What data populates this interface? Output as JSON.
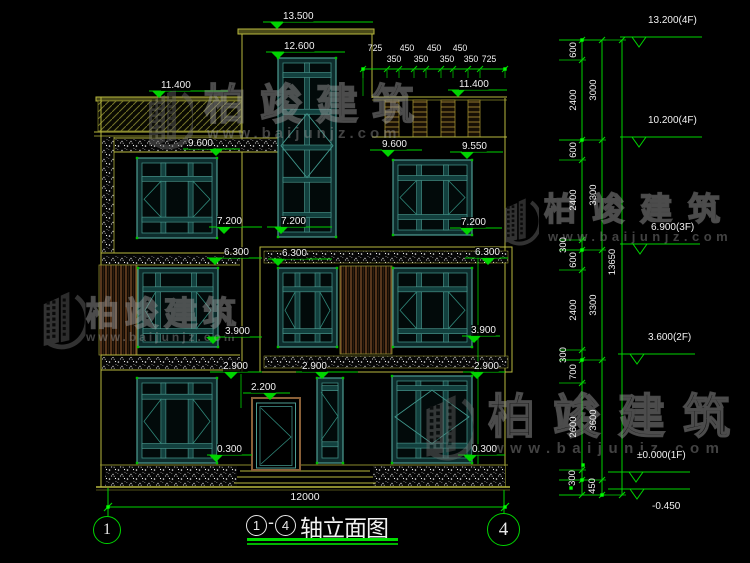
{
  "drawing": {
    "title": {
      "axis_start": "1",
      "dash": "-",
      "axis_end": "4",
      "name": "轴立面图"
    },
    "overall_dim": {
      "value": "12000",
      "x": 305,
      "y": 492
    },
    "axis_bubbles": [
      {
        "label": "1"
      },
      {
        "label": "4"
      }
    ]
  },
  "watermark": {
    "brand": "柏竣建筑",
    "url": "www.baijunjz.com",
    "instances": [
      {
        "logo": [
          143,
          86,
          1.0
        ],
        "zh": [
          204,
          84,
          42,
          14
        ],
        "u": [
          207,
          126,
          15,
          4
        ]
      },
      {
        "logo": [
          38,
          289,
          0.95
        ],
        "zh": [
          86,
          297,
          33,
          6
        ],
        "u": [
          86,
          331,
          12,
          3
        ]
      },
      {
        "logo": [
          500,
          196,
          0.78
        ],
        "zh": [
          544,
          193,
          32,
          16
        ],
        "u": [
          548,
          230,
          13,
          4.5
        ]
      },
      {
        "logo": [
          420,
          392,
          1.08
        ],
        "zh": [
          488,
          393,
          47,
          18
        ],
        "u": [
          492,
          441,
          15,
          6.5
        ]
      }
    ]
  },
  "elevation_markers_main": [
    {
      "v": "13.500",
      "x": 283,
      "y": 11,
      "tip": 277,
      "l1": 263,
      "l2": 373
    },
    {
      "v": "12.600",
      "x": 284,
      "y": 41,
      "tip": 278,
      "l1": 266,
      "l2": 345
    },
    {
      "v": "11.400",
      "x": 161,
      "y": 80,
      "tip": 159,
      "l1": 149,
      "l2": 228
    },
    {
      "v": "11.400",
      "x": 459,
      "y": 79,
      "tip": 458,
      "l1": 448,
      "l2": 507
    },
    {
      "v": "9.600",
      "x": 188,
      "y": 138,
      "tip": 216,
      "l1": 183,
      "l2": 240
    },
    {
      "v": "9.600",
      "x": 382,
      "y": 139,
      "tip": 388,
      "l1": 370,
      "l2": 422
    },
    {
      "v": "9.550",
      "x": 462,
      "y": 141,
      "tip": 467,
      "l1": 450,
      "l2": 503
    },
    {
      "v": "7.200",
      "x": 217,
      "y": 216,
      "tip": 224,
      "l1": 209,
      "l2": 262
    },
    {
      "v": "7.200",
      "x": 281,
      "y": 216,
      "tip": 281,
      "l1": 267,
      "l2": 332
    },
    {
      "v": "7.200",
      "x": 461,
      "y": 217,
      "tip": 467,
      "l1": 450,
      "l2": 502
    },
    {
      "v": "6.300",
      "x": 224,
      "y": 247,
      "tip": 215,
      "l1": 207,
      "l2": 262
    },
    {
      "v": "6.300",
      "x": 282,
      "y": 248,
      "tip": 278,
      "l1": 268,
      "l2": 332
    },
    {
      "v": "6.300",
      "x": 475,
      "y": 247,
      "tip": 488,
      "l1": 465,
      "l2": 508
    },
    {
      "v": "3.900",
      "x": 225,
      "y": 326,
      "tip": 213,
      "l1": 208,
      "l2": 262
    },
    {
      "v": "3.900",
      "x": 471,
      "y": 325,
      "tip": 474,
      "l1": 462,
      "l2": 500
    },
    {
      "v": "2.900",
      "x": 223,
      "y": 361,
      "tip": 231,
      "l1": 210,
      "l2": 262
    },
    {
      "v": "2.900",
      "x": 302,
      "y": 361,
      "tip": 322,
      "l1": 296,
      "l2": 358
    },
    {
      "v": "2.900",
      "x": 474,
      "y": 361,
      "tip": 477,
      "l1": 463,
      "l2": 505
    },
    {
      "v": "2.200",
      "x": 251,
      "y": 382,
      "tip": 270,
      "l1": 243,
      "l2": 290
    },
    {
      "v": "0.300",
      "x": 217,
      "y": 444,
      "tip": 216,
      "l1": 207,
      "l2": 252
    },
    {
      "v": "0.300",
      "x": 472,
      "y": 444,
      "tip": 470,
      "l1": 458,
      "l2": 505
    }
  ],
  "elevation_markers_right": [
    {
      "v": "13.200(4F)",
      "x": 648,
      "y": 15,
      "tip": 639,
      "l1": 620,
      "l2": 702
    },
    {
      "v": "10.200(4F)",
      "x": 648,
      "y": 115,
      "tip": 639,
      "l1": 620,
      "l2": 702
    },
    {
      "v": "6.900(3F)",
      "x": 651,
      "y": 222,
      "tip": 640,
      "l1": 620,
      "l2": 700
    },
    {
      "v": "3.600(2F)",
      "x": 648,
      "y": 332,
      "tip": 637,
      "l1": 618,
      "l2": 695
    },
    {
      "v": "±0.000(1F)",
      "x": 637,
      "y": 450,
      "tip": 636,
      "l1": 608,
      "l2": 690
    },
    {
      "v": "-0.450",
      "x": 652,
      "y": 501,
      "tip": 637,
      "l1": 608,
      "l2": 690,
      "below": true
    }
  ],
  "top_dims": {
    "row1": [
      {
        "v": "725",
        "cx": 375
      },
      {
        "v": "450",
        "cx": 407
      },
      {
        "v": "450",
        "cx": 434
      },
      {
        "v": "450",
        "cx": 460
      }
    ],
    "row2": [
      {
        "v": "350",
        "cx": 394
      },
      {
        "v": "350",
        "cx": 421
      },
      {
        "v": "350",
        "cx": 447
      },
      {
        "v": "350",
        "cx": 471
      },
      {
        "v": "725",
        "cx": 489
      }
    ],
    "ticks": [
      363,
      387,
      399,
      414,
      426,
      441,
      453,
      468,
      480,
      505
    ]
  },
  "right_chain": {
    "cols": [
      {
        "x": 582,
        "boundaries": [
          40,
          60,
          140,
          160,
          240,
          250,
          270,
          350,
          360,
          383,
          470,
          480,
          495
        ],
        "labels": [
          {
            "v": "600",
            "cx": 574,
            "cy": 50
          },
          {
            "v": "2400",
            "cx": 574,
            "cy": 100
          },
          {
            "v": "600",
            "cx": 574,
            "cy": 150
          },
          {
            "v": "2400",
            "cx": 574,
            "cy": 200
          },
          {
            "v": "300",
            "cx": 564,
            "cy": 245
          },
          {
            "v": "600",
            "cx": 574,
            "cy": 260
          },
          {
            "v": "2400",
            "cx": 574,
            "cy": 310
          },
          {
            "v": "300",
            "cx": 564,
            "cy": 355
          },
          {
            "v": "700",
            "cx": 574,
            "cy": 372
          },
          {
            "v": "2600",
            "cx": 574,
            "cy": 427
          },
          {
            "v": "300",
            "cx": 573,
            "cy": 478
          }
        ]
      },
      {
        "x": 602,
        "boundaries": [
          40,
          140,
          250,
          360,
          480,
          495
        ],
        "labels": [
          {
            "v": "3000",
            "cx": 594,
            "cy": 90
          },
          {
            "v": "3300",
            "cx": 594,
            "cy": 195
          },
          {
            "v": "3300",
            "cx": 594,
            "cy": 305
          },
          {
            "v": "3600",
            "cx": 594,
            "cy": 420
          },
          {
            "v": "450",
            "cx": 593,
            "cy": 486
          }
        ]
      },
      {
        "x": 622,
        "boundaries": [
          40,
          495
        ],
        "labels": [
          {
            "v": "13650",
            "cx": 613,
            "cy": 262
          }
        ]
      }
    ]
  }
}
